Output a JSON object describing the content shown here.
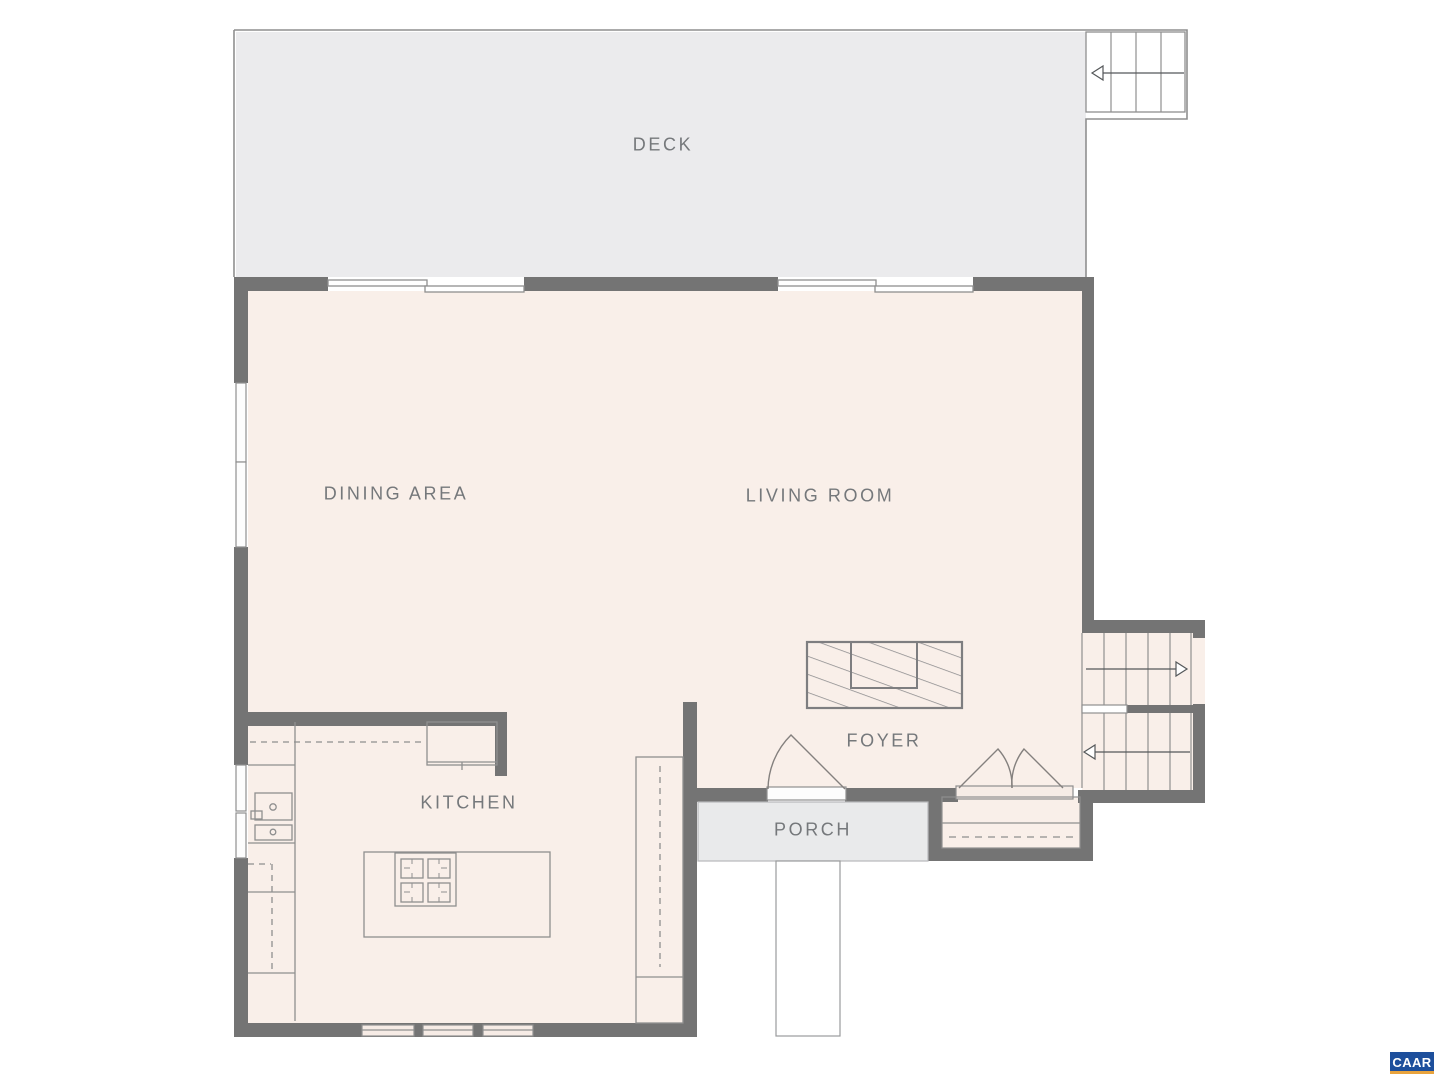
{
  "plan": {
    "rooms": [
      {
        "id": "deck",
        "label": "DECK"
      },
      {
        "id": "dining",
        "label": "DINING AREA"
      },
      {
        "id": "living",
        "label": "LIVING ROOM"
      },
      {
        "id": "kitchen",
        "label": "KITCHEN"
      },
      {
        "id": "foyer",
        "label": "FOYER"
      },
      {
        "id": "porch",
        "label": "PORCH"
      }
    ],
    "logo": {
      "text": "CAAR"
    },
    "colors": {
      "floor": "#f9efe9",
      "deck": "#ebebed",
      "porch": "#e9eaeb",
      "wall": "#747474",
      "line": "#8f8f8f",
      "label": "#75787b",
      "logo-blue": "#1d4f9c",
      "logo-orange": "#e8a33d"
    }
  }
}
